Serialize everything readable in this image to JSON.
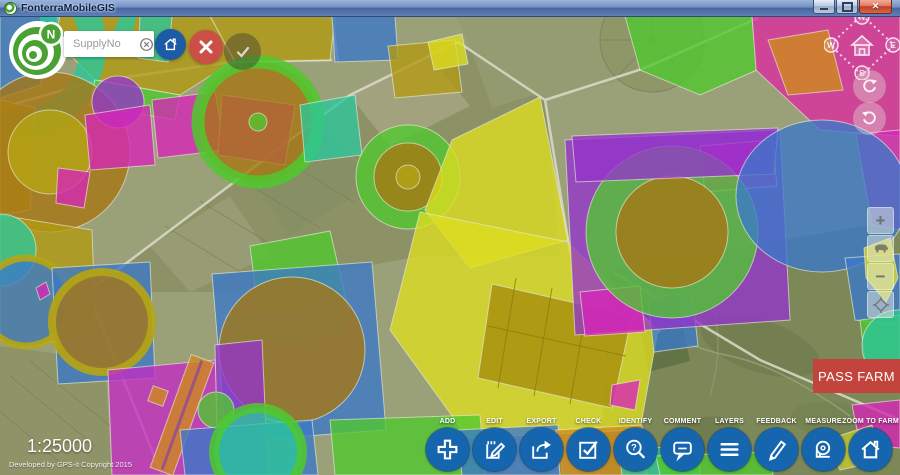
{
  "window": {
    "title": "FonterraMobileGIS",
    "controls": [
      {
        "name": "minimize"
      },
      {
        "name": "maximize"
      },
      {
        "name": "close"
      }
    ]
  },
  "search": {
    "placeholder": "SupplyNo",
    "clear_icon": "circled-x-icon",
    "logo_letter": "N"
  },
  "quick_actions": {
    "home_button_icon": "house-icon",
    "cancel_button_icon": "x-icon",
    "confirm_button_icon": "check-icon"
  },
  "compass": {
    "north": "N",
    "east": "E",
    "south": "S",
    "west": "W",
    "center_icon": "house-icon"
  },
  "map_controls": {
    "zoom_in": "+",
    "zoom_out": "−",
    "middle_icon": "cow-icon",
    "reset_icon": "gps-diamond-icon",
    "rotate_cw_icon": "rotate-clockwise-icon",
    "rotate_ccw_icon": "rotate-counterclockwise-icon"
  },
  "pass_farm": {
    "label": "PASS FARM",
    "color": "#c2443c"
  },
  "scale": {
    "label": "1:25000"
  },
  "credit": {
    "label": "Developed by GPS-it Copyright 2015"
  },
  "toolbar": {
    "button_color": "#1566af",
    "items": [
      {
        "label": "ADD",
        "icon": "plus-icon"
      },
      {
        "label": "EDIT",
        "icon": "edit-note-icon"
      },
      {
        "label": "EXPORT",
        "icon": "export-arrow-icon"
      },
      {
        "label": "CHECK",
        "icon": "checkbox-icon"
      },
      {
        "label": "IDENTIFY",
        "icon": "magnifier-question-icon"
      },
      {
        "label": "COMMENT",
        "icon": "speech-bubble-icon"
      },
      {
        "label": "LAYERS",
        "icon": "layers-lines-icon"
      },
      {
        "label": "FEEDBACK",
        "icon": "pencil-icon"
      },
      {
        "label": "MEASURE",
        "icon": "measuring-tape-icon"
      },
      {
        "label": "ZOOM TO FARM",
        "icon": "house-icon"
      }
    ]
  },
  "map": {
    "description": "satellite farmland with colored supply-parcel overlays and center-pivot irrigation circles",
    "palette": {
      "satellite_base": "#9aa078",
      "satellite_hills": "#7d8859",
      "parcel_green": "#4fc92e",
      "parcel_teal": "#2bc79b",
      "parcel_blue": "#3a78c9",
      "parcel_magenta": "#d724b8",
      "parcel_pink": "#dd2ba0",
      "parcel_purple": "#9333cc",
      "parcel_yellow": "#dede20",
      "parcel_olive": "#b29a12",
      "parcel_brown": "#a87612",
      "parcel_orange": "#cf8c1a"
    }
  }
}
